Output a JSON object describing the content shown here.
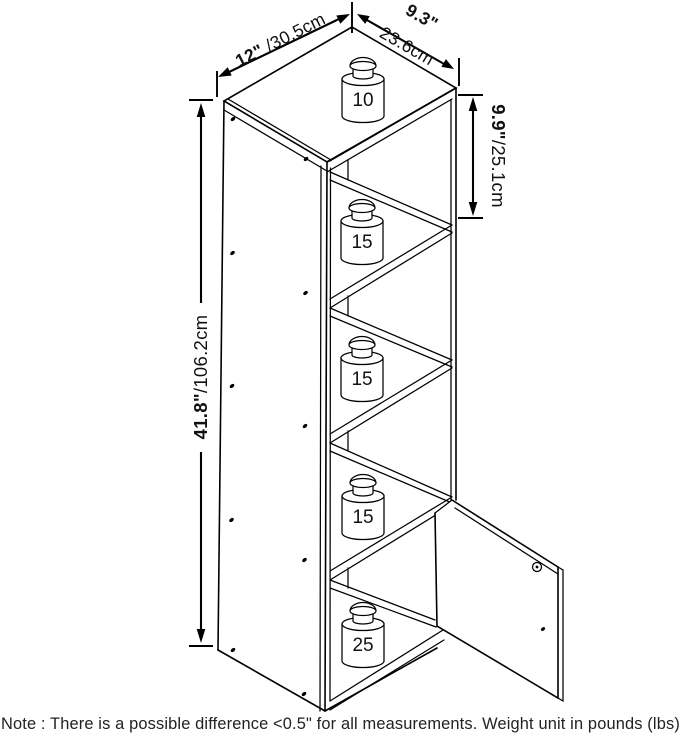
{
  "diagram": {
    "title": "bookcase-dimension-diagram",
    "dimensions": {
      "width": {
        "inch": "12\"",
        "metric": " /30.5cm"
      },
      "depth": {
        "inch": "9.3\"",
        "metric": "23.6cm"
      },
      "total_height": {
        "inch": "41.8\"",
        "metric": "/106.2cm"
      },
      "opening_height": {
        "inch": "9.9\"",
        "metric": "/25.1cm"
      }
    },
    "weight_capacities": [
      {
        "location": "top-surface",
        "value": "10"
      },
      {
        "location": "shelf-1",
        "value": "15"
      },
      {
        "location": "shelf-2",
        "value": "15"
      },
      {
        "location": "shelf-3",
        "value": "15"
      },
      {
        "location": "bottom-shelf",
        "value": "25"
      }
    ],
    "note": "Note : There is a possible difference <0.5\" for all measurements. Weight unit in pounds (lbs).",
    "colors": {
      "line": "#000000",
      "text": "#111111",
      "background": "#ffffff"
    }
  }
}
